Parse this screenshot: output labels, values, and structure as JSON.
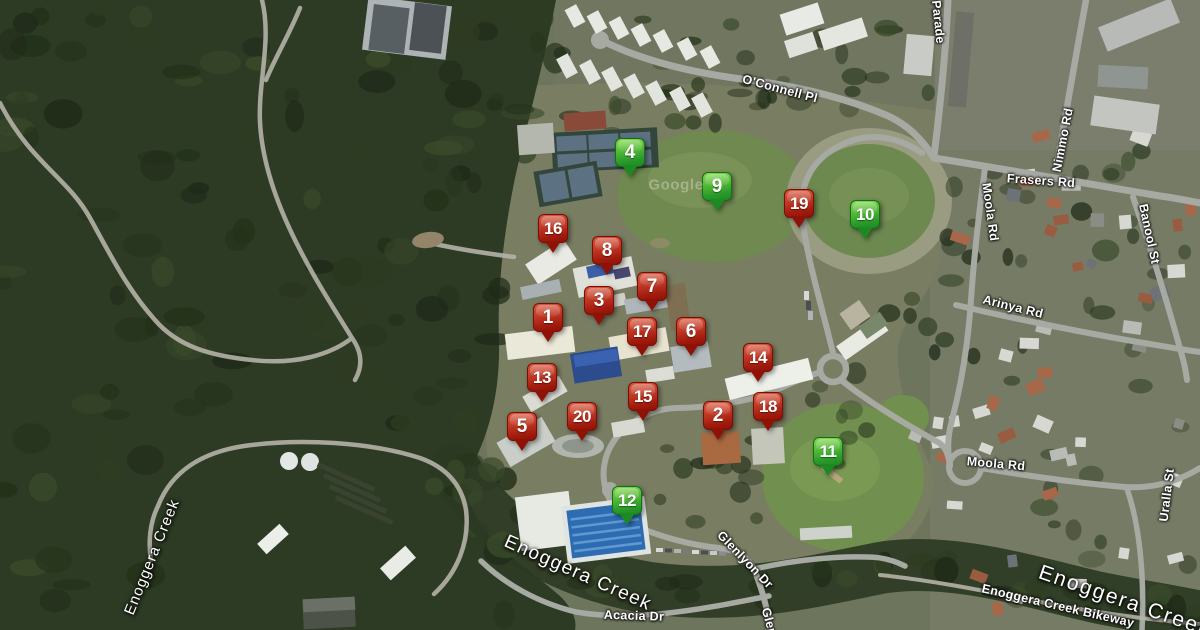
{
  "map": {
    "watermark": "Google",
    "marker_palette": {
      "red_top": "#d8593f",
      "red_bottom": "#8e1206",
      "red_border": "#7a0e05",
      "green_top": "#84d94e",
      "green_bottom": "#1d8a21",
      "green_border": "#156f19",
      "number_color": "#ffffff"
    },
    "markers": [
      {
        "n": "4",
        "color": "green",
        "x": 630,
        "y": 178
      },
      {
        "n": "9",
        "color": "green",
        "x": 717,
        "y": 212
      },
      {
        "n": "19",
        "color": "red",
        "x": 799,
        "y": 229
      },
      {
        "n": "10",
        "color": "green",
        "x": 865,
        "y": 240
      },
      {
        "n": "16",
        "color": "red",
        "x": 553,
        "y": 254
      },
      {
        "n": "8",
        "color": "red",
        "x": 607,
        "y": 276
      },
      {
        "n": "7",
        "color": "red",
        "x": 652,
        "y": 312
      },
      {
        "n": "3",
        "color": "red",
        "x": 599,
        "y": 326
      },
      {
        "n": "1",
        "color": "red",
        "x": 548,
        "y": 343
      },
      {
        "n": "17",
        "color": "red",
        "x": 642,
        "y": 357
      },
      {
        "n": "6",
        "color": "red",
        "x": 691,
        "y": 357
      },
      {
        "n": "14",
        "color": "red",
        "x": 758,
        "y": 383
      },
      {
        "n": "13",
        "color": "red",
        "x": 542,
        "y": 403
      },
      {
        "n": "15",
        "color": "red",
        "x": 643,
        "y": 422
      },
      {
        "n": "18",
        "color": "red",
        "x": 768,
        "y": 432
      },
      {
        "n": "2",
        "color": "red",
        "x": 718,
        "y": 441
      },
      {
        "n": "20",
        "color": "red",
        "x": 582,
        "y": 442
      },
      {
        "n": "5",
        "color": "red",
        "x": 522,
        "y": 452
      },
      {
        "n": "11",
        "color": "green",
        "x": 828,
        "y": 477
      },
      {
        "n": "12",
        "color": "green",
        "x": 627,
        "y": 526
      }
    ],
    "labels": [
      {
        "text": "O'Connell Pl",
        "x": 780,
        "y": 89,
        "rot": 15,
        "size": 12.5,
        "kind": "road"
      },
      {
        "text": "Parade",
        "x": 938,
        "y": 22,
        "rot": 84,
        "size": 12.5,
        "kind": "road"
      },
      {
        "text": "Nimmo Rd",
        "x": 1063,
        "y": 140,
        "rot": -79,
        "size": 12.5,
        "kind": "road"
      },
      {
        "text": "Frasers Rd",
        "x": 1041,
        "y": 181,
        "rot": 4,
        "size": 12.5,
        "kind": "road"
      },
      {
        "text": "Moola Rd",
        "x": 990,
        "y": 212,
        "rot": 82,
        "size": 12.5,
        "kind": "road"
      },
      {
        "text": "Banool St",
        "x": 1149,
        "y": 234,
        "rot": 78,
        "size": 12.5,
        "kind": "road"
      },
      {
        "text": "Arinya Rd",
        "x": 1013,
        "y": 307,
        "rot": 14,
        "size": 12.5,
        "kind": "road"
      },
      {
        "text": "Moola Rd",
        "x": 996,
        "y": 464,
        "rot": 5,
        "size": 12.5,
        "kind": "road"
      },
      {
        "text": "Uralla St",
        "x": 1167,
        "y": 495,
        "rot": -83,
        "size": 12.5,
        "kind": "road"
      },
      {
        "text": "Glenlyon Dr",
        "x": 745,
        "y": 560,
        "rot": 46,
        "size": 12.5,
        "kind": "road"
      },
      {
        "text": "Glen",
        "x": 769,
        "y": 622,
        "rot": 75,
        "size": 12.5,
        "kind": "road"
      },
      {
        "text": "Acacia Dr",
        "x": 634,
        "y": 616,
        "rot": 2,
        "size": 12.5,
        "kind": "road"
      },
      {
        "text": "Enoggera Creek",
        "x": 152,
        "y": 557,
        "rot": -68,
        "size": 15,
        "spacing": 1,
        "kind": "water"
      },
      {
        "text": "Enoggera Creek",
        "x": 578,
        "y": 573,
        "rot": 24,
        "size": 19,
        "spacing": 1.5,
        "kind": "water"
      },
      {
        "text": "Enoggera Creek",
        "x": 1125,
        "y": 601,
        "rot": 19,
        "size": 21,
        "spacing": 2,
        "kind": "water"
      },
      {
        "text": "Enoggera Creek Bikeway",
        "x": 1058,
        "y": 606,
        "rot": 13,
        "size": 12.5,
        "kind": "path"
      }
    ]
  }
}
